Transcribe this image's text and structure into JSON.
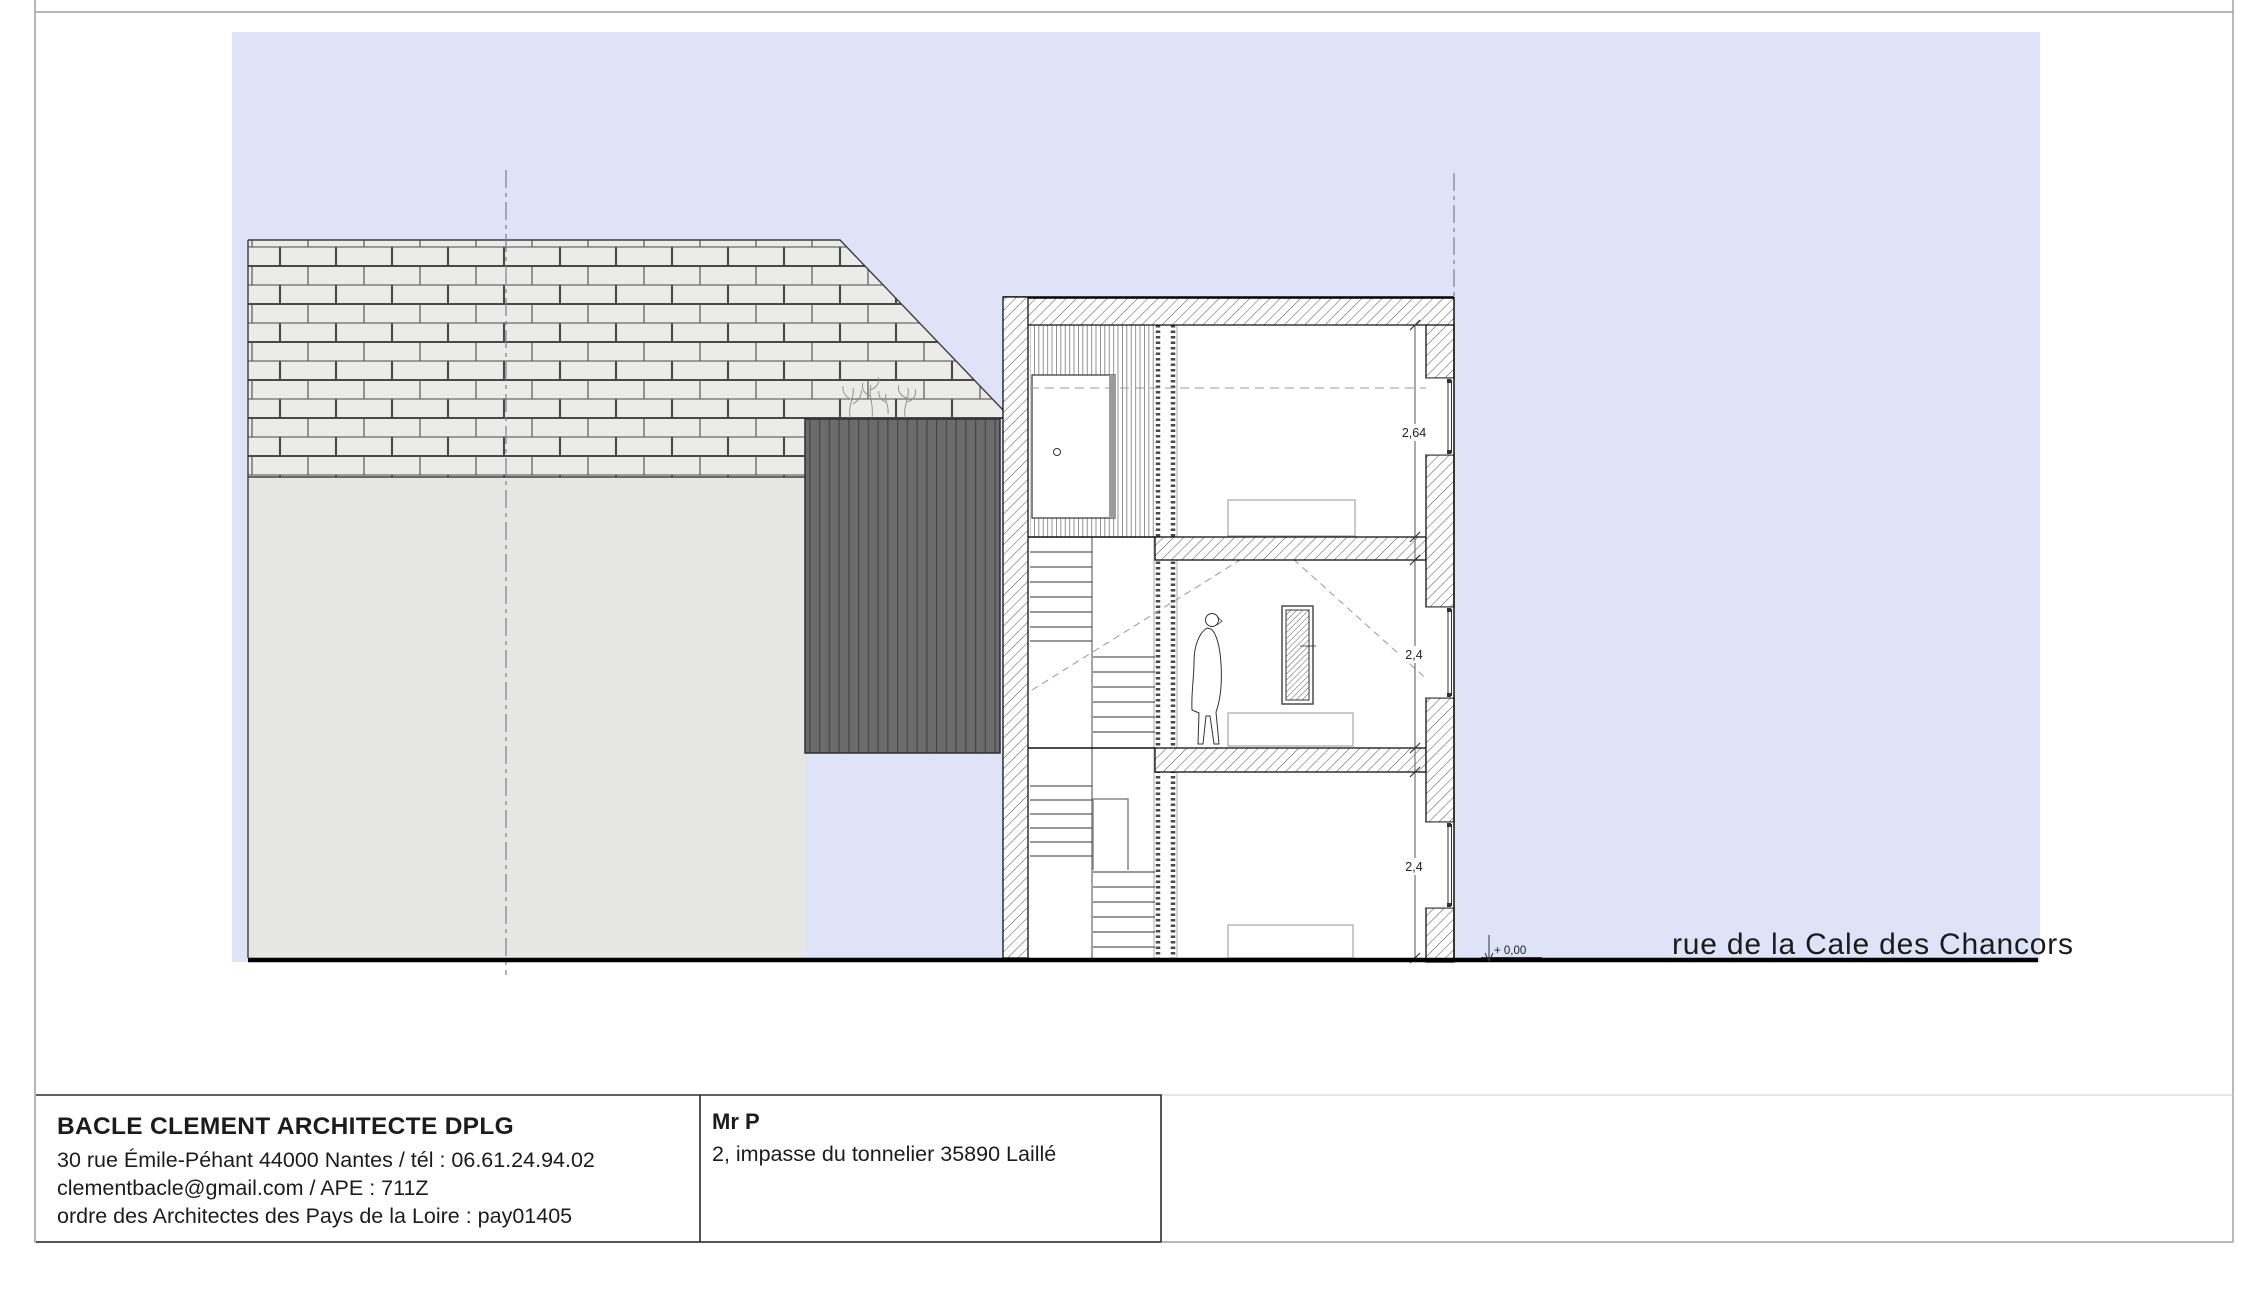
{
  "drawing": {
    "street_label": "rue de la Cale des Chancors",
    "level_marker": "+ 0,00",
    "dimensions": {
      "floor_top": "2,64",
      "floor_middle": "2,4",
      "floor_ground": "2,4"
    },
    "colors": {
      "sky": "#dfe3f7",
      "fence": "#6b6b6b",
      "brick_face": "#ebebe9",
      "brick_joint": "#4a4a4a",
      "render_wall": "#e6e6e4",
      "hatch_line": "#3f3f3f",
      "ground_line": "#000000"
    }
  },
  "title_block": {
    "architect": {
      "name": "BACLE CLEMENT ARCHITECTE DPLG",
      "address_line": "30 rue Émile-Péhant 44000 Nantes / tél : 06.61.24.94.02",
      "email_line": "clementbacle@gmail.com / APE : 711Z",
      "order_line": "ordre des Architectes des Pays de la Loire : pay01405"
    },
    "client": {
      "name": "Mr P",
      "address": "2, impasse du tonnelier 35890 Laillé"
    }
  }
}
